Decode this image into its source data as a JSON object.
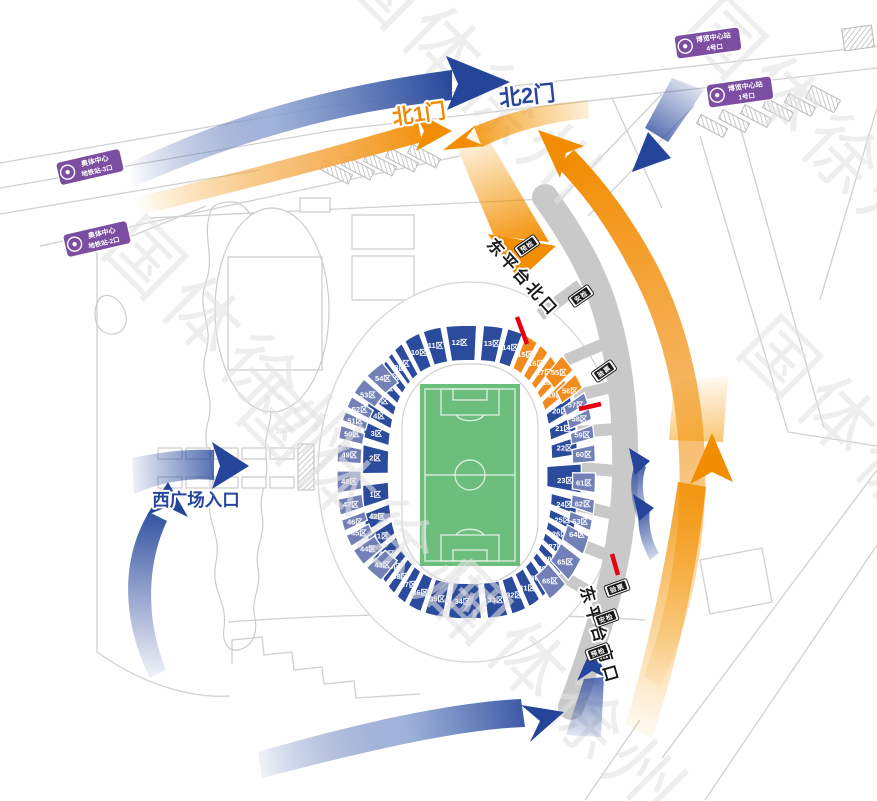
{
  "watermark": {
    "text": "国体徐州"
  },
  "gates": {
    "north1": "北1门",
    "north2": "北2门",
    "west_plaza": "西广场入口",
    "east_platform_north": "东平台北口",
    "east_platform_south": "东平台南口"
  },
  "metro_badges": [
    {
      "line1": "奥体中心",
      "line2": "地铁站-3口"
    },
    {
      "line1": "奥体中心",
      "line2": "地铁站-2口"
    },
    {
      "line1": "博览中心站",
      "line2": "4号口"
    },
    {
      "line1": "博览中心站",
      "line2": "1号口"
    }
  ],
  "checkpoint_badges": {
    "north_path": [
      "预检",
      "安检",
      "验票"
    ],
    "south_path": [
      "验票",
      "安检",
      "预检"
    ]
  },
  "colors": {
    "section_blue": "#2B4B9C",
    "section_outer": "#7280B7",
    "section_orange": "#F28B1D",
    "route_blue": "#24459A",
    "route_orange": "#F39800",
    "field_green": "#6CBE7D",
    "metro_purple": "#7C4EA1",
    "closure_red": "#E60012",
    "path_gray": "#C9C9C9"
  },
  "stadium": {
    "inner_sections": [
      {
        "label": "9区",
        "t": -128
      },
      {
        "label": "10区",
        "t": -116
      },
      {
        "label": "11区",
        "t": -105
      },
      {
        "label": "12区",
        "t": -93
      },
      {
        "label": "13区",
        "t": -82
      },
      {
        "label": "14区",
        "t": -71.5
      },
      {
        "label": "15区",
        "t": -61,
        "c": "o"
      },
      {
        "label": "16区",
        "t": -52,
        "c": "o"
      },
      {
        "label": "17区",
        "t": -44.5,
        "c": "o"
      },
      {
        "label": "18区",
        "t": -37.5,
        "c": "o"
      },
      {
        "label": "19区",
        "t": -30,
        "c": "o"
      },
      {
        "label": "20区",
        "t": -21.5
      },
      {
        "label": "21区",
        "t": -13.5
      },
      {
        "label": "22区",
        "t": -6
      },
      {
        "label": "23区",
        "t": 1.5,
        "r0": 0.8,
        "r1": 1.16
      },
      {
        "label": "24区",
        "t": 9
      },
      {
        "label": "25区",
        "t": 15.5
      },
      {
        "label": "26区",
        "t": 22
      },
      {
        "label": "27区",
        "t": 28.5
      },
      {
        "label": "28区",
        "t": 36
      },
      {
        "label": "29区",
        "t": 42.5
      },
      {
        "label": "30区",
        "t": 50
      },
      {
        "label": "31区",
        "t": 59.5
      },
      {
        "label": "32区",
        "t": 69
      },
      {
        "label": "33区",
        "t": 80
      },
      {
        "label": "34区",
        "t": 92
      },
      {
        "label": "35区",
        "t": 104
      },
      {
        "label": "36区",
        "t": 115
      },
      {
        "label": "37区",
        "t": 124
      },
      {
        "label": "38区",
        "t": 131.5
      },
      {
        "label": "39区",
        "t": 139
      },
      {
        "label": "40区",
        "t": 147
      },
      {
        "label": "41区",
        "t": 157
      },
      {
        "label": "42区",
        "t": 166
      },
      {
        "label": "1区",
        "t": 174.5
      },
      {
        "label": "2区",
        "t": 183
      },
      {
        "label": "3区",
        "t": 191.5
      },
      {
        "label": "4区",
        "t": 199
      },
      {
        "label": "5区",
        "t": 206.5
      },
      {
        "label": "6区",
        "t": 214
      },
      {
        "label": "7区",
        "t": 221.5
      },
      {
        "label": "8区",
        "t": 228.5
      }
    ],
    "outer_west_sections": [
      {
        "label": "54区",
        "t": 228.5
      },
      {
        "label": "53区",
        "t": 216
      },
      {
        "label": "52区",
        "t": 207
      },
      {
        "label": "51区",
        "t": 200.5
      },
      {
        "label": "50区",
        "t": 194
      },
      {
        "label": "49区",
        "t": 185
      },
      {
        "label": "48区",
        "t": 177.5
      },
      {
        "label": "47区",
        "t": 168.5
      },
      {
        "label": "46区",
        "t": 160
      },
      {
        "label": "45区",
        "t": 154
      },
      {
        "label": "44区",
        "t": 144
      },
      {
        "label": "43区",
        "t": 132
      }
    ],
    "outer_east_sections": [
      {
        "label": "55区",
        "t": -43,
        "c": "o"
      },
      {
        "label": "56区",
        "t": -32,
        "c": "o"
      },
      {
        "label": "57区",
        "t": -24.5
      },
      {
        "label": "58区",
        "t": -18
      },
      {
        "label": "59区",
        "t": -11.5
      },
      {
        "label": "60区",
        "t": -4.5
      },
      {
        "label": "61区",
        "t": 2.5
      },
      {
        "label": "62区",
        "t": 9.5
      },
      {
        "label": "63区",
        "t": 16.5
      },
      {
        "label": "64区",
        "t": 22.5
      },
      {
        "label": "65区",
        "t": 37
      },
      {
        "label": "66区",
        "t": 50
      }
    ]
  }
}
